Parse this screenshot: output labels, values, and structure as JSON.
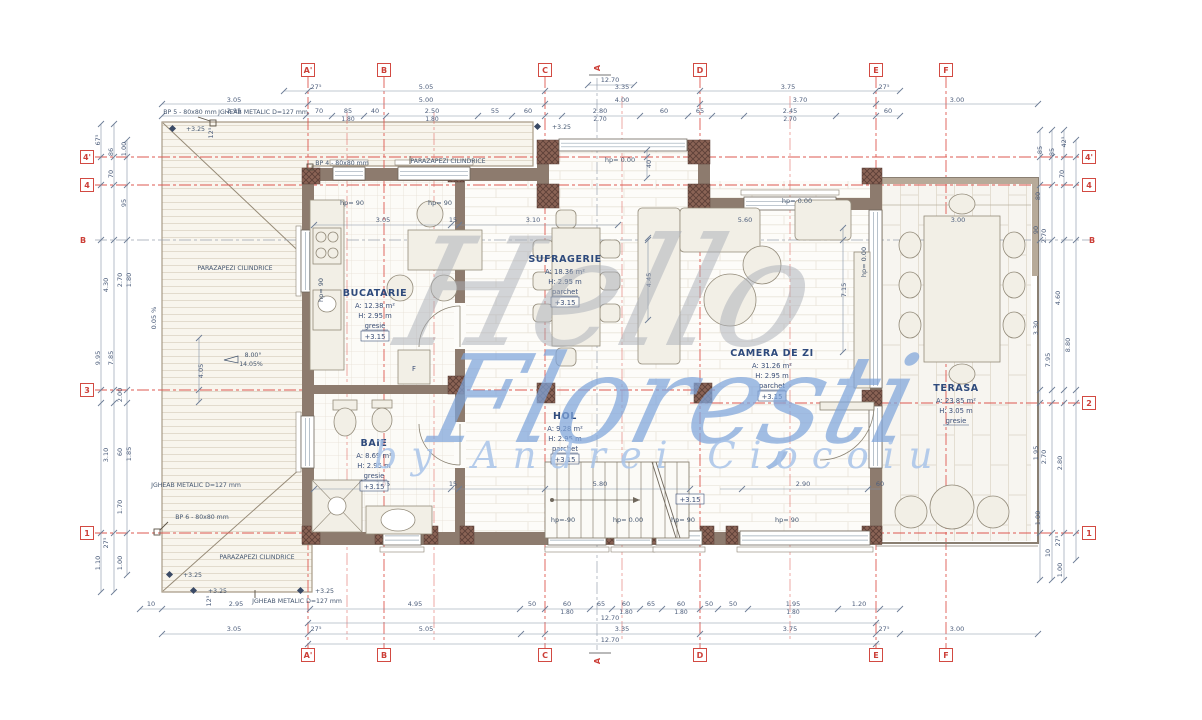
{
  "watermark": {
    "line1": "Hello",
    "line2": "Florești",
    "line3": "by Andrei Ciocoiu"
  },
  "grid": {
    "cols": [
      "A'",
      "B",
      "C",
      "D",
      "E",
      "F"
    ],
    "rows_left": [
      "4'",
      "4",
      "B",
      "3",
      "1"
    ],
    "rows_right": [
      "4'",
      "4",
      "B",
      "2",
      "1"
    ],
    "section": "A"
  },
  "rooms": {
    "bucatarie": {
      "name": "BUCATARIE",
      "area": "A: 12.38 m²",
      "height": "H: 2.95 m",
      "floor": "gresie",
      "level": "+3.15"
    },
    "sufragerie": {
      "name": "SUFRAGERIE",
      "area": "A: 18.36 m²",
      "height": "H: 2.95 m",
      "floor": "parchet",
      "level": "+3.15"
    },
    "camera_de_zi": {
      "name": "CAMERA DE ZI",
      "area": "A: 31.26 m²",
      "height": "H: 2.95 m",
      "floor": "parchet",
      "level": "+3.15"
    },
    "hol": {
      "name": "HOL",
      "area": "A: 9.28 m²",
      "height": "H: 2.95 m",
      "floor": "parchet",
      "level": "+3.15"
    },
    "baie": {
      "name": "BAIE",
      "area": "A: 8.69 m²",
      "height": "H: 2.95 m",
      "floor": "gresie",
      "level": "+3.15"
    },
    "terasa": {
      "name": "TERASA",
      "area": "A: 23.85 m²",
      "height": "H: 3.05 m",
      "floor": "gresie",
      "level": ""
    }
  },
  "annotations": {
    "parazapezi": "PARAZAPEZI CILINDRICE",
    "jgheab": "JGHEAB METALIC D=127 mm",
    "bp4": "BP 4 - 80x80 mm",
    "bp5": "BP 5 - 80x80 mm",
    "bp6": "BP 6 - 80x80 mm",
    "level_roof": "+3.25",
    "level_floor": "+3.15",
    "slope_deg": "8.00°",
    "slope_pct": "14.05%",
    "slope_flat": "0.05 %",
    "hp90": "hp= 90",
    "hp0": "hp= 0.00",
    "hpm90": "hp=-90",
    "fridge": "F"
  },
  "dims": {
    "top_total": "12.70",
    "top_r1": [
      "27⁵",
      "5.05",
      "3.35",
      "3.75",
      "27⁵"
    ],
    "top_r2": [
      "3.05",
      "5.00",
      "4.00",
      "3.70",
      "3.00"
    ],
    "top_r3": [
      "2.95",
      "70",
      "85",
      "40",
      "2.50",
      "55",
      "60",
      "2.80",
      "60",
      "65",
      "2.45",
      "60"
    ],
    "top_r3b": [
      "1.80",
      "1.80",
      "2.70",
      "2.70"
    ],
    "inner_top": [
      "3.05",
      "15",
      "3.10",
      "5.60",
      "3.00"
    ],
    "inner_bot": [
      "3.05",
      "15",
      "5.80",
      "2.90",
      "60"
    ],
    "bot_r1": [
      "10",
      "2.95",
      "4.95",
      "50",
      "60",
      "65",
      "60",
      "65",
      "60",
      "50",
      "50",
      "1.95",
      "1.20"
    ],
    "bot_r1b": [
      "1.80",
      "1.80",
      "1.80",
      "1.80"
    ],
    "bot_total": "12.70",
    "bot_r2": [
      "3.05",
      "27⁵",
      "5.05",
      "3.35",
      "3.75",
      "27⁵",
      "3.00"
    ],
    "bot_total2": "12.70",
    "left": [
      "67⁵",
      "86",
      "1.00",
      "70",
      "95",
      "2.70",
      "1.80",
      "4.30",
      "9.95",
      "7.85",
      "2.00",
      "3.10",
      "60",
      "1.85",
      "1.70",
      "27⁵",
      "1.10",
      "1.00"
    ],
    "right": [
      "85",
      "85",
      "42⁵",
      "70",
      "80",
      "90",
      "2.70",
      "4.60",
      "3.30",
      "8.80",
      "7.95",
      "1.95",
      "2.70",
      "2.80",
      "1.00",
      "27⁵",
      "10",
      "1.00"
    ],
    "inner_rot": [
      "4.45",
      "7.15",
      "40",
      "4.05",
      "0.05 %",
      "12⁵",
      "12⁵"
    ]
  }
}
